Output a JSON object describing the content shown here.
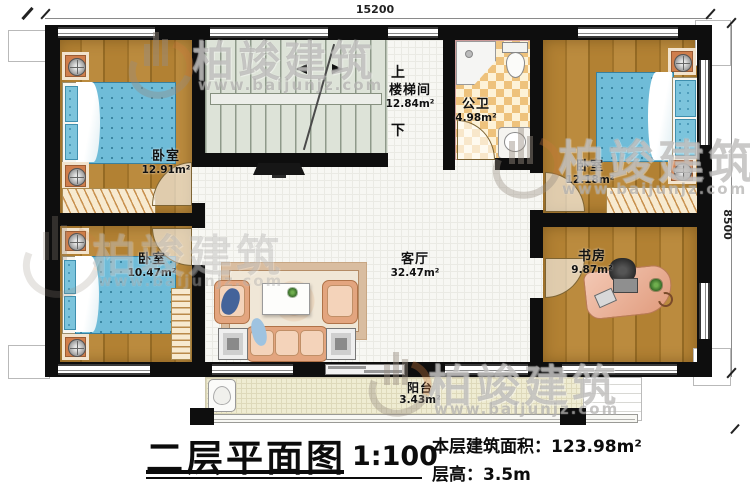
{
  "plan": {
    "dim_top": "15200",
    "dim_right": "8500",
    "rooms": {
      "bedroom_top_left": {
        "name": "卧室",
        "area": "12.91m²"
      },
      "bedroom_bottom_left": {
        "name": "卧室",
        "area": "10.47m²"
      },
      "bedroom_right": {
        "name": "卧室",
        "area": "12.18m²"
      },
      "stairwell": {
        "name": "楼梯间",
        "area": "12.84m²"
      },
      "bathroom": {
        "name": "公卫",
        "area": "4.98m²"
      },
      "living_room": {
        "name": "客厅",
        "area": "32.47m²"
      },
      "study": {
        "name": "书房",
        "area": "9.87m²"
      },
      "balcony": {
        "name": "阳台",
        "area": "3.43m²"
      }
    },
    "stairs": {
      "up_label": "上",
      "down_label": "下"
    }
  },
  "title_block": {
    "title": "二层平面图",
    "scale": "1:100",
    "area_label": "本层建筑面积：",
    "area_value": "123.98m²",
    "height_label": "层高：",
    "height_value": "3.5m"
  },
  "watermark": {
    "brand": "柏竣建筑",
    "url": "www.baijunjz.com"
  }
}
